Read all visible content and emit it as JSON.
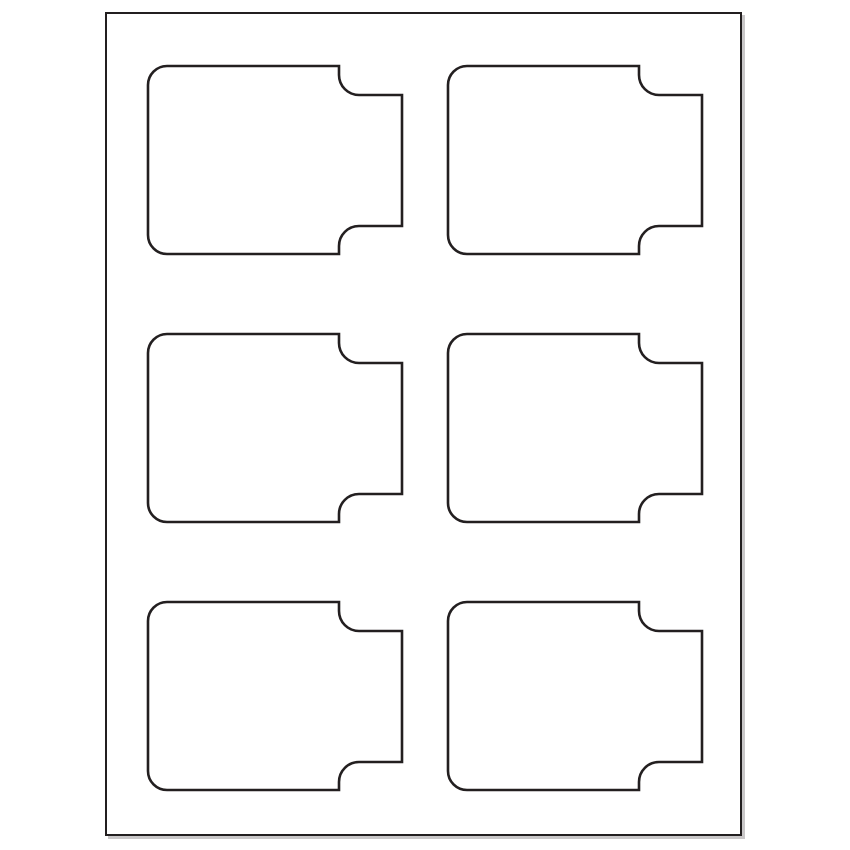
{
  "canvas": {
    "width": 850,
    "height": 850,
    "background_color": "#ffffff"
  },
  "sheet": {
    "description": "blank-label-template-page",
    "x": 105,
    "y": 12,
    "width": 637,
    "height": 824,
    "fill_color": "#ffffff",
    "border_color": "#231f20",
    "border_width": 2.6,
    "shadow_color": "#c9c7c8",
    "shadow_offset": 3,
    "rows": 3,
    "columns": 2,
    "label_count": 6
  },
  "label_shape": {
    "description": "rounded-rect-label-with-right-side-tab",
    "path": "M 19 0 H 191 V 9 A 20 20 0 0 0 211 29 H 254 V 160 H 211 A 20 20 0 0 0 191 180 V 188 H 19 A 19 19 0 0 1 0 169 V 19 A 19 19 0 0 1 19 0 Z",
    "width": 254,
    "height": 188,
    "stroke_color": "#231f20",
    "stroke_width": 2.6,
    "fill_color": "#ffffff"
  },
  "labels": [
    {
      "id": "label-1",
      "row": 1,
      "col": 1,
      "x": 148,
      "y": 66
    },
    {
      "id": "label-2",
      "row": 1,
      "col": 2,
      "x": 448,
      "y": 66
    },
    {
      "id": "label-3",
      "row": 2,
      "col": 1,
      "x": 148,
      "y": 334
    },
    {
      "id": "label-4",
      "row": 2,
      "col": 2,
      "x": 448,
      "y": 334
    },
    {
      "id": "label-5",
      "row": 3,
      "col": 1,
      "x": 148,
      "y": 602
    },
    {
      "id": "label-6",
      "row": 3,
      "col": 2,
      "x": 448,
      "y": 602
    }
  ]
}
